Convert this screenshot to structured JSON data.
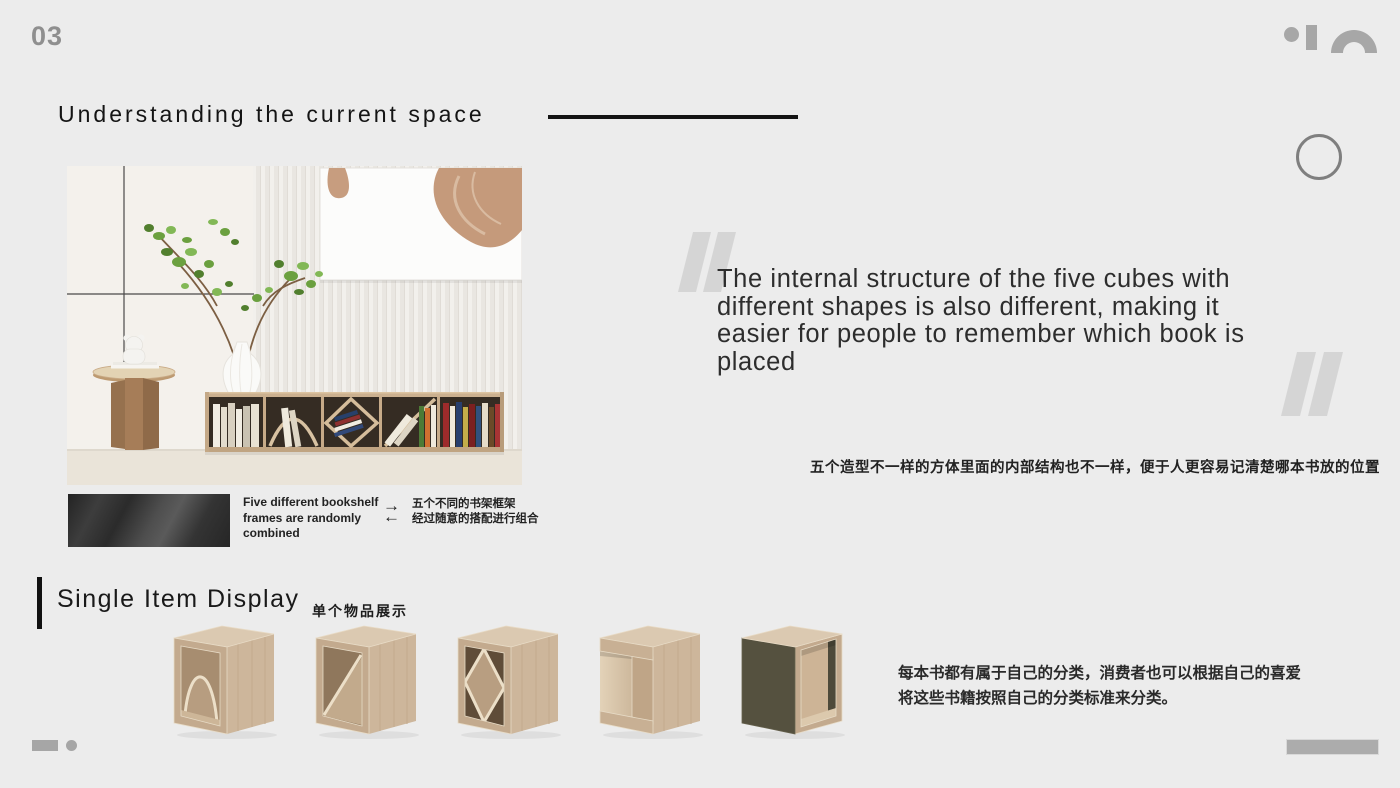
{
  "page_number": "03",
  "header": {
    "title": "Understanding the current space"
  },
  "quote": {
    "lines": [
      "The internal structure of the five cubes with",
      "different shapes is also different, making it",
      "easier for people to remember which book is",
      "placed"
    ]
  },
  "note_zh": "五个造型不一样的方体里面的内部结构也不一样，便于人更容易记清楚哪本书放的位置",
  "detail": {
    "caption_en": "Five different bookshelf frames are randomly combined",
    "caption_zh_line1": "五个不同的书架框架",
    "caption_zh_line2": "经过随意的搭配进行组合",
    "arrow_right": "→",
    "arrow_left": "←"
  },
  "section": {
    "title": "Single Item Display",
    "subtitle_zh": "单个物品展示"
  },
  "products": {
    "items": [
      "arch-frame-cube",
      "diagonal-frame-cube",
      "diamond-frame-cube",
      "c-shape-frame-cube",
      "dark-panel-frame-cube"
    ]
  },
  "description_zh": {
    "line1": "每本书都有属于自己的分类，消费者也可以根据自己的喜爱",
    "line2": "将这些书籍按照自己的分类标准来分类。"
  },
  "colors": {
    "background": "#ececec",
    "ink": "#1a1a1a",
    "muted_gray": "#a7a7a7",
    "quote_mark": "#d5d5d5",
    "wood": "#cdb69b",
    "wood_dark": "#ab9279",
    "panel_dark": "#55513f"
  }
}
